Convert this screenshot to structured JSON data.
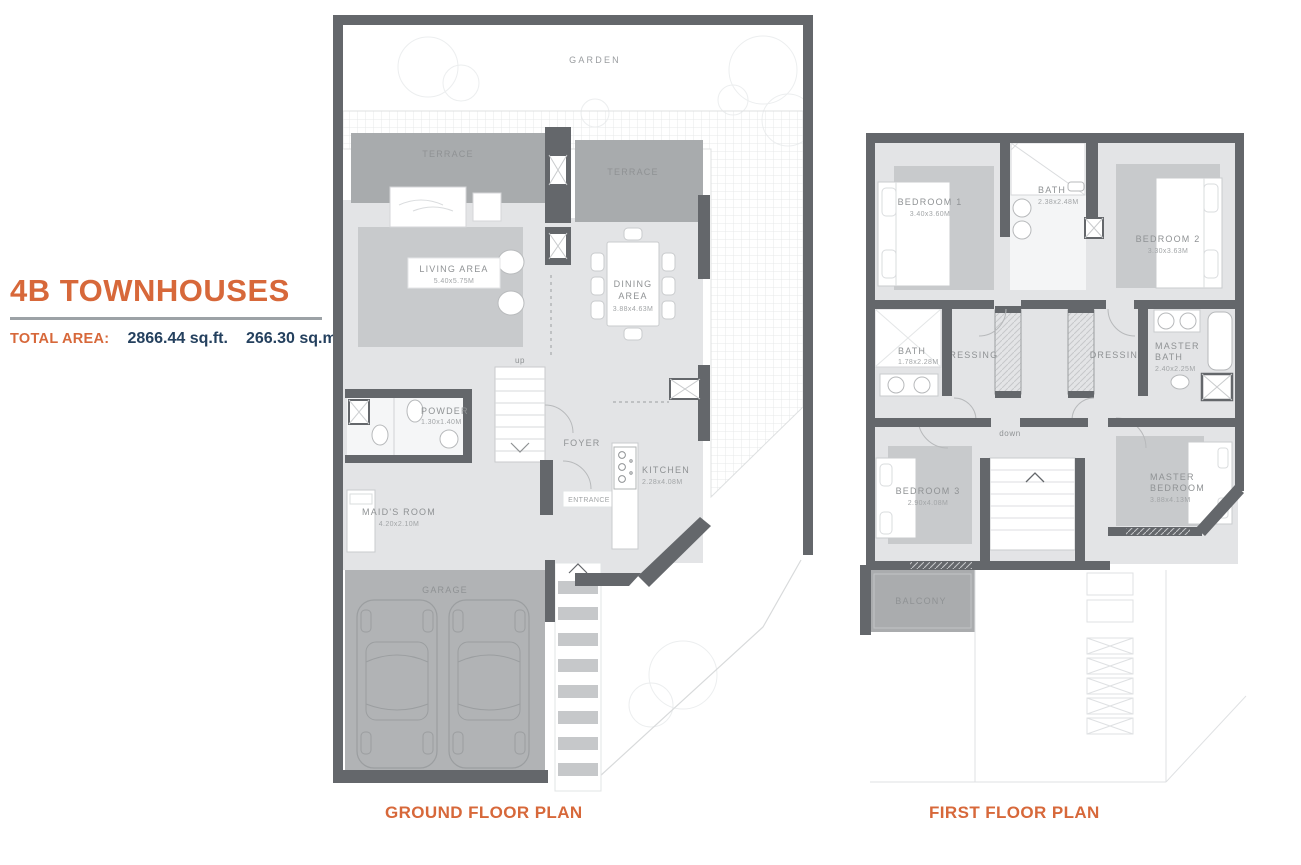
{
  "header": {
    "title": "4B TOWNHOUSES",
    "total_area_label": "TOTAL AREA:",
    "area_sqft": "2866.44 sq.ft.",
    "area_sqm": "266.30 sq.m."
  },
  "colors": {
    "accent_orange": "#D7683A",
    "value_navy": "#24405E",
    "wall_gray": "#64676B",
    "terrace_gray": "#A8ABAD",
    "room_gray": "#E3E4E6",
    "rug_gray": "#C8CACC"
  },
  "ground_floor": {
    "caption": "GROUND FLOOR PLAN",
    "labels": {
      "garden": "GARDEN",
      "terrace_left": "TERRACE",
      "terrace_right": "TERRACE",
      "living_area": "LIVING AREA",
      "living_area_dim": "5.40x5.75M",
      "dining_line1": "DINING",
      "dining_line2": "AREA",
      "dining_dim": "3.88x4.63M",
      "up": "up",
      "powder": "POWDER",
      "powder_dim": "1.30x1.40M",
      "foyer": "FOYER",
      "kitchen": "KITCHEN",
      "kitchen_dim": "2.28x4.08M",
      "maids_room": "MAID'S ROOM",
      "maids_room_dim": "4.20x2.10M",
      "entrance": "ENTRANCE",
      "garage": "GARAGE"
    }
  },
  "first_floor": {
    "caption": "FIRST FLOOR PLAN",
    "labels": {
      "bedroom1": "BEDROOM 1",
      "bedroom1_dim": "3.40x3.60M",
      "bath_top": "BATH",
      "bath_top_dim": "2.38x2.48M",
      "bedroom2": "BEDROOM 2",
      "bedroom2_dim": "3.30x3.63M",
      "bath_mid": "BATH",
      "bath_mid_dim": "1.78x2.28M",
      "dressing_left": "DRESSING",
      "dressing_right": "DRESSING",
      "master_bath_line1": "MASTER",
      "master_bath_line2": "BATH",
      "master_bath_dim": "2.40x2.25M",
      "down": "down",
      "bedroom3": "BEDROOM 3",
      "bedroom3_dim": "2.90x4.08M",
      "master_bedroom_line1": "MASTER",
      "master_bedroom_line2": "BEDROOM",
      "master_bedroom_dim": "3.88x4.13M",
      "balcony": "BALCONY"
    }
  }
}
